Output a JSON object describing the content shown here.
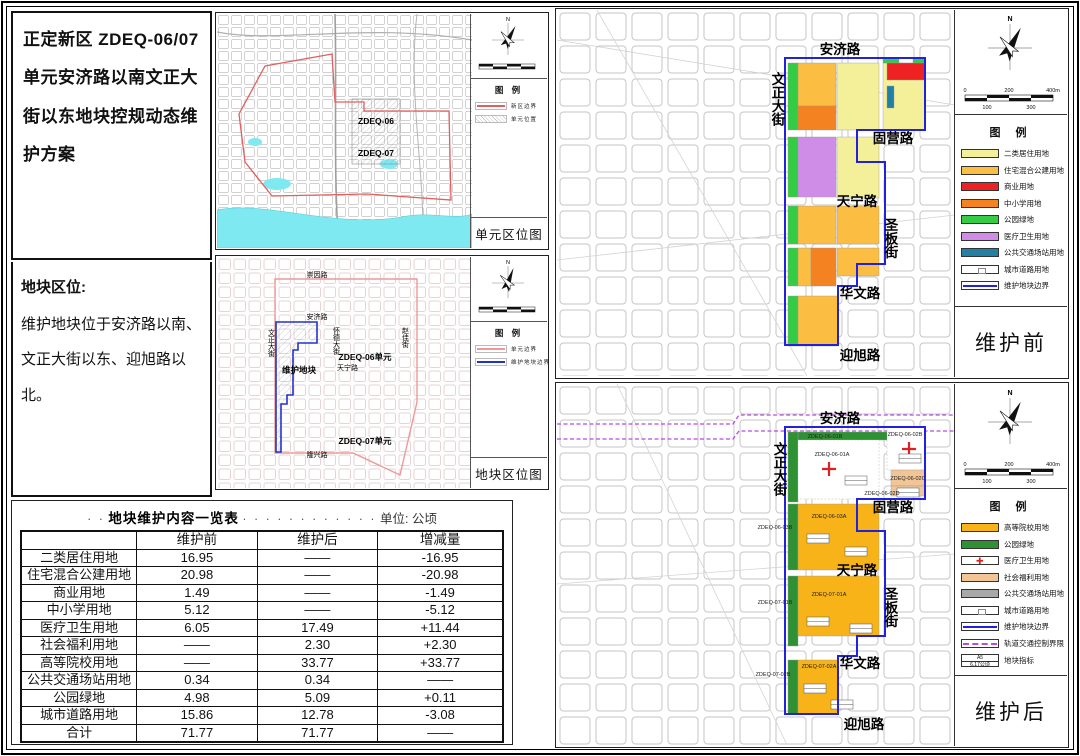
{
  "doc": {
    "title": "正定新区 ZDEQ-06/07单元安济路以南文正大街以东地块控规动态维护方案",
    "location_heading": "地块区位:",
    "location_line1": "维护地块位于安济路以南、",
    "location_line2": "文正大街以东、迎旭路以北。"
  },
  "unit_map": {
    "title": "单元区位图",
    "legend_title": "图 例",
    "legend": [
      {
        "label": "新区边界",
        "color": "#E06060"
      },
      {
        "label": "单元位置"
      }
    ],
    "unit06": "ZDEQ-06",
    "unit07": "ZDEQ-07",
    "compass": "N"
  },
  "block_map": {
    "title": "地块区位图",
    "legend_title": "图 例",
    "legend": [
      {
        "label": "单元边界",
        "color": "#E06060"
      },
      {
        "label": "维护地块边界",
        "color": "#2233CC"
      }
    ],
    "roads": {
      "chongyin": "崇因路",
      "anji": "安济路",
      "wenzheng": "文正大街",
      "huaide": "怀德大街",
      "zhaojia": "赵佳街",
      "tianning": "天宁路",
      "longxing": "隆兴路"
    },
    "unit06": "ZDEQ-06单元",
    "unit07": "ZDEQ-07单元",
    "plot_label": "维护地块",
    "compass": "N"
  },
  "roads": {
    "anji": "安济路",
    "wenzheng": "文正大街",
    "guying": "固营路",
    "tianning": "天宁路",
    "shengban": "圣板街",
    "huawen": "华文路",
    "yingxu": "迎旭路"
  },
  "before_map": {
    "title": "维护前",
    "legend_title": "图 例",
    "legend": [
      {
        "label": "二类居住用地",
        "color": "#F4F09A"
      },
      {
        "label": "住宅混合公建用地",
        "color": "#FBBE42"
      },
      {
        "label": "商业用地",
        "color": "#EE2222"
      },
      {
        "label": "中小学用地",
        "color": "#F58220"
      },
      {
        "label": "公园绿地",
        "color": "#33CC44"
      },
      {
        "label": "医疗卫生用地",
        "color": "#CF8DE8"
      },
      {
        "label": "公共交通场站用地",
        "color": "#2380A5"
      },
      {
        "label": "城市道路用地",
        "color": "#FFFFFF"
      },
      {
        "label": "维护地块边界",
        "color": "#2222DD"
      }
    ],
    "compass": "N",
    "scale_labels": {
      "s0": "0",
      "s100": "100",
      "s200": "200",
      "s300": "300",
      "s400": "400m"
    }
  },
  "after_map": {
    "title": "维护后",
    "legend_title": "图 例",
    "legend": [
      {
        "label": "高等院校用地",
        "color": "#F7B318"
      },
      {
        "label": "公园绿地",
        "color": "#2E9235"
      },
      {
        "label": "医疗卫生用地",
        "color": "#FFFFFF"
      },
      {
        "label": "社会福利用地",
        "color": "#F2C596"
      },
      {
        "label": "公共交通场站用地",
        "color": "#A8A8A8"
      },
      {
        "label": "城市道路用地",
        "color": "#FFFFFF"
      },
      {
        "label": "维护地块边界",
        "color": "#2222DD"
      },
      {
        "label": "轨道交通控制界限",
        "color": "#B44CE0"
      },
      {
        "label": "地块指标",
        "sample_top": "A5",
        "sample_bottom": "6.17公顷"
      }
    ],
    "blocks": {
      "b01b": "ZDEQ-06-01B",
      "b01a": "ZDEQ-06-01A",
      "b02b": "ZDEQ-06-02B",
      "b02c": "ZDEQ-06-02C",
      "b02d": "ZDEQ-06-02D",
      "b03b": "ZDEQ-06-03B",
      "b03a": "ZDEQ-06-03A",
      "b71b": "ZDEQ-07-01B",
      "b71a": "ZDEQ-07-01A",
      "b72a": "ZDEQ-07-02A",
      "b72b": "ZDEQ-07-02B"
    },
    "compass": "N",
    "scale_labels": {
      "s0": "0",
      "s100": "100",
      "s200": "200",
      "s300": "300",
      "s400": "400m"
    }
  },
  "table": {
    "leader_left": "· ·",
    "title": "地块维护内容一览表",
    "leader_right": "· · · · · · · · · · · ·",
    "unit": "单位: 公顷",
    "columns": [
      "",
      "维护前",
      "维护后",
      "增减量"
    ],
    "rows": [
      [
        "二类居住用地",
        "16.95",
        "——",
        "-16.95"
      ],
      [
        "住宅混合公建用地",
        "20.98",
        "——",
        "-20.98"
      ],
      [
        "商业用地",
        "1.49",
        "——",
        "-1.49"
      ],
      [
        "中小学用地",
        "5.12",
        "——",
        "-5.12"
      ],
      [
        "医疗卫生用地",
        "6.05",
        "17.49",
        "+11.44"
      ],
      [
        "社会福利用地",
        "——",
        "2.30",
        "+2.30"
      ],
      [
        "高等院校用地",
        "——",
        "33.77",
        "+33.77"
      ],
      [
        "公共交通场站用地",
        "0.34",
        "0.34",
        "——"
      ],
      [
        "公园绿地",
        "4.98",
        "5.09",
        "+0.11"
      ],
      [
        "城市道路用地",
        "15.86",
        "12.78",
        "-3.08"
      ],
      [
        "合计",
        "71.77",
        "71.77",
        "——"
      ]
    ]
  }
}
